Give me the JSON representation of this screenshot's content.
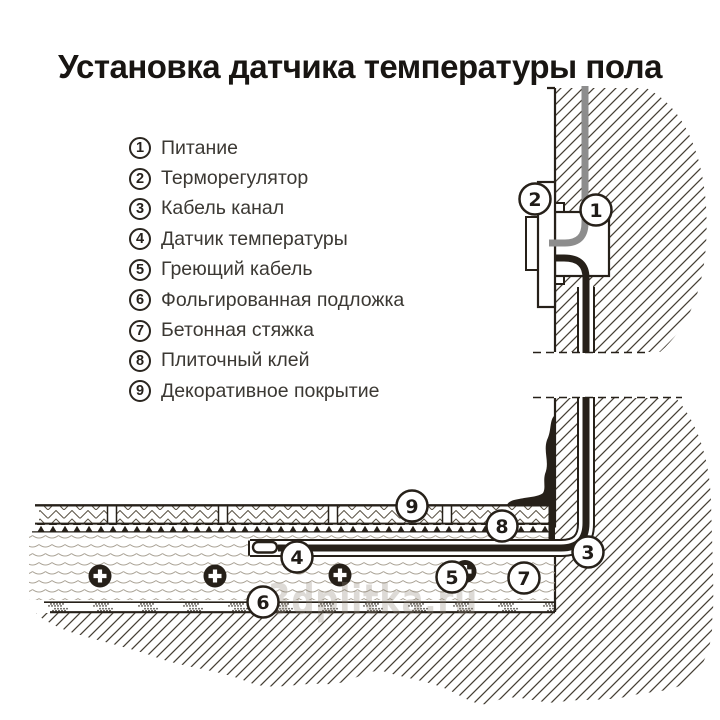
{
  "title": "Установка датчика температуры пола",
  "legend": {
    "items": [
      {
        "num": "1",
        "label": "Питание"
      },
      {
        "num": "2",
        "label": "Терморегулятор"
      },
      {
        "num": "3",
        "label": "Кабель канал"
      },
      {
        "num": "4",
        "label": "Датчик температуры"
      },
      {
        "num": "5",
        "label": "Греющий кабель"
      },
      {
        "num": "6",
        "label": "Фольгированная подложка"
      },
      {
        "num": "7",
        "label": "Бетонная стяжка"
      },
      {
        "num": "8",
        "label": "Плиточный клей"
      },
      {
        "num": "9",
        "label": "Декоративное покрытие"
      }
    ]
  },
  "diagram": {
    "callouts": [
      "1",
      "2",
      "3",
      "4",
      "5",
      "6",
      "7",
      "8",
      "9"
    ],
    "watermark": "3dplitka.ru",
    "colors": {
      "ink": "#262019",
      "cable_gray": "#8d8d8d",
      "hatch_line": "#453f35",
      "screed_wave": "#aaa396",
      "watermark": "#8d8477"
    }
  }
}
